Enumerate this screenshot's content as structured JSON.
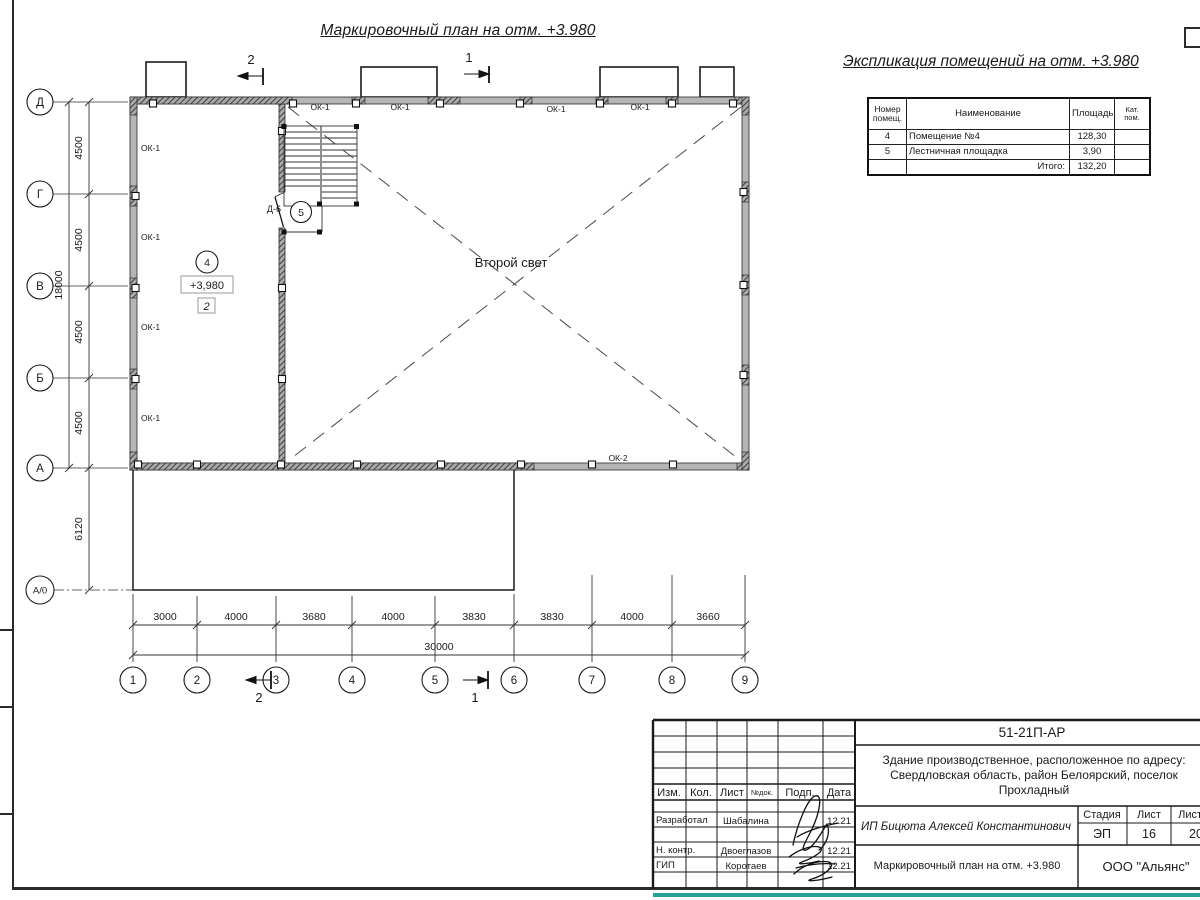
{
  "page": {
    "main_title": "Маркировочный план на отм. +3.980"
  },
  "schedule": {
    "title": "Экспликация помещений на отм. +3.980",
    "headers": {
      "num": "Номер помещ.",
      "name": "Наименование",
      "area": "Площадь",
      "cat": "Кат. пом."
    },
    "rows": [
      {
        "num": "4",
        "name": "Помещение №4",
        "area": "128,30",
        "cat": ""
      },
      {
        "num": "5",
        "name": "Лестничная площадка",
        "area": "3,90",
        "cat": ""
      }
    ],
    "total_label": "Итого:",
    "total_value": "132,20"
  },
  "plan": {
    "axes_v": [
      "Д",
      "Г",
      "В",
      "Б",
      "А",
      "А/0"
    ],
    "axes_h": [
      "1",
      "2",
      "3",
      "4",
      "5",
      "6",
      "7",
      "8",
      "9"
    ],
    "dims_v": [
      "4500",
      "4500",
      "4500",
      "4500"
    ],
    "dim_v_low": "6120",
    "dim_v_total": "18000",
    "dims_h": [
      "3000",
      "4000",
      "3680",
      "4000",
      "3830",
      "3830",
      "4000",
      "3660"
    ],
    "dim_h_total": "30000",
    "window_label_1": "ОК-1",
    "window_label_2": "ОК-2",
    "door_label": "Д-6",
    "room4_num": "4",
    "room5_num": "5",
    "elevation_mark": "+3,980",
    "zone_num": "2",
    "void_label": "Второй свет",
    "section_1": "1",
    "section_2": "2"
  },
  "stamp": {
    "doc_number": "51-21П-АР",
    "address": "Здание производственное, расположенное по адресу: Свердловская область, район Белоярский, поселок Прохладный",
    "client": "ИП Бицюта Алексей Константинович",
    "col_headers": {
      "izm": "Изм.",
      "kol": "Кол.",
      "list": "Лист",
      "ndok": "№док.",
      "podp": "Подп.",
      "data": "Дата"
    },
    "stage_header": "Стадия",
    "sheet_header": "Лист",
    "sheets_header": "Листов",
    "stage": "ЭП",
    "sheet": "16",
    "sheets": "20",
    "rows": [
      {
        "role": "Разработал",
        "name": "Шабалина",
        "date": "12.21"
      },
      {
        "role": "Н. контр.",
        "name": "Двоеглазов",
        "date": "12.21"
      },
      {
        "role": "ГИП",
        "name": "Коротаев",
        "date": "12.21"
      }
    ],
    "drawing_title": "Маркировочный план на отм. +3.980",
    "company": "ООО \"Альянс\""
  },
  "colors": {
    "wall_fill": "#b5b5b5",
    "hatch_dark": "#2b2b2b",
    "accent_strip": "#2aa198"
  }
}
